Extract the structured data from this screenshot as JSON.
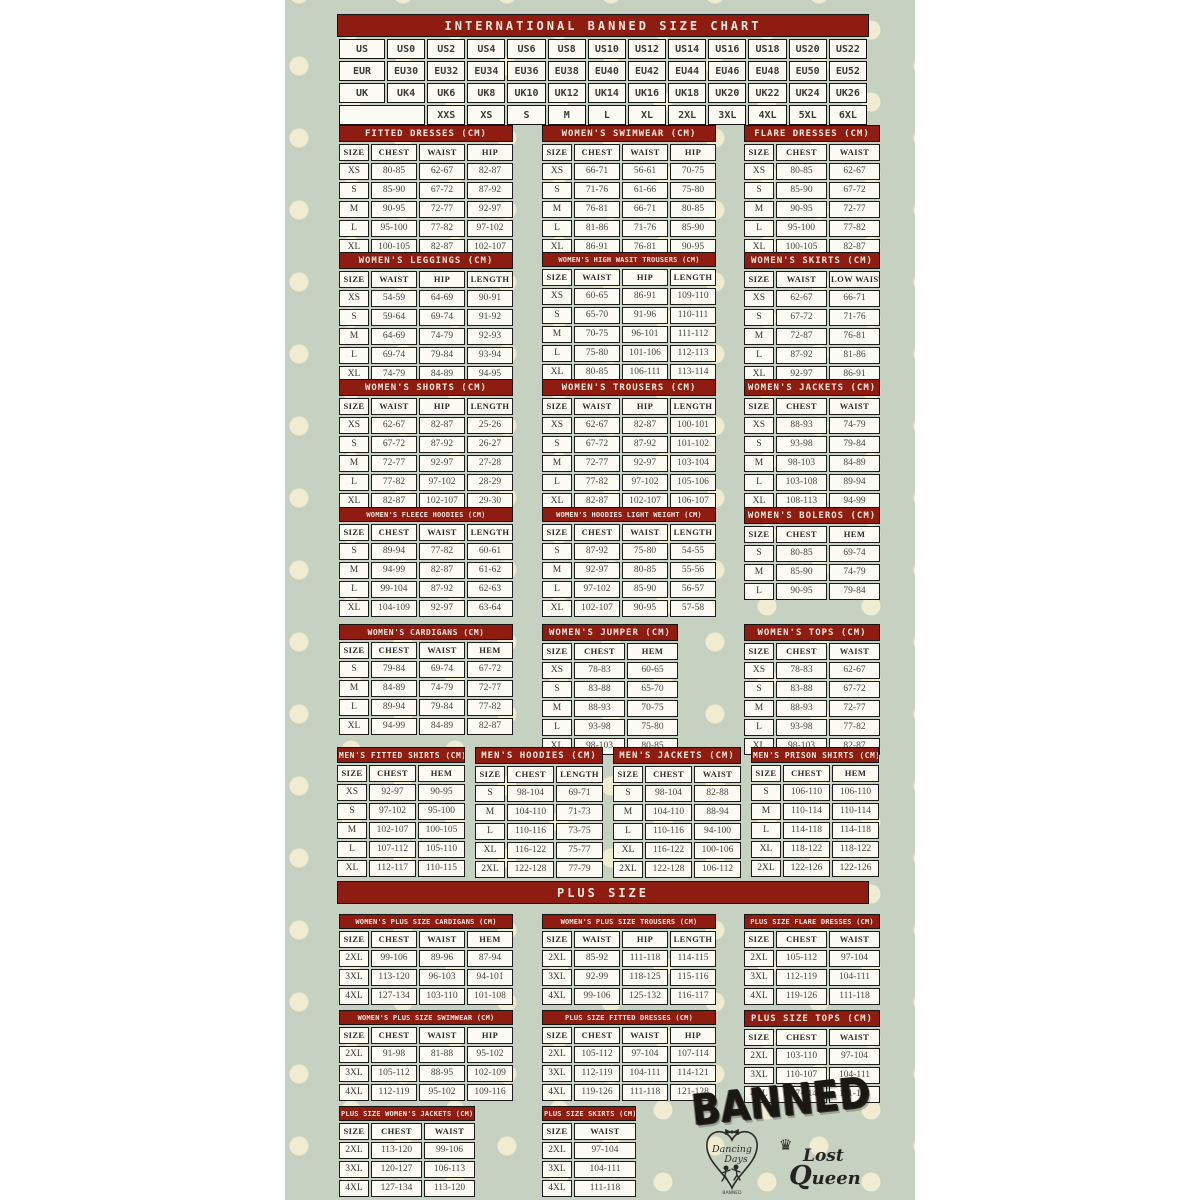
{
  "colors": {
    "header_red": "#8e1c10",
    "background_sage": "#c6d1c2",
    "dot_cream": "#efecd2",
    "cell_bg": "#fbfaf3",
    "border_black": "#1c1c1c"
  },
  "banner": {
    "title": "INTERNATIONAL BANNED SIZE CHART",
    "plus_size": "PLUS SIZE"
  },
  "international": {
    "rows": [
      [
        "US",
        "US0",
        "US2",
        "US4",
        "US6",
        "US8",
        "US10",
        "US12",
        "US14",
        "US16",
        "US18",
        "US20",
        "US22"
      ],
      [
        "EUR",
        "EU30",
        "EU32",
        "EU34",
        "EU36",
        "EU38",
        "EU40",
        "EU42",
        "EU44",
        "EU46",
        "EU48",
        "EU50",
        "EU52"
      ],
      [
        "UK",
        "UK4",
        "UK6",
        "UK8",
        "UK10",
        "UK12",
        "UK14",
        "UK16",
        "UK18",
        "UK20",
        "UK22",
        "UK24",
        "UK26"
      ],
      [
        "",
        "XXS",
        "XS",
        "S",
        "M",
        "L",
        "XL",
        "2XL",
        "3XL",
        "4XL",
        "5XL",
        "6XL"
      ]
    ]
  },
  "tables": {
    "fitted_dresses": {
      "title": "FITTED DRESSES (CM)",
      "headers": [
        "SIZE",
        "CHEST",
        "WAIST",
        "HIP"
      ],
      "rows": [
        [
          "XS",
          "80-85",
          "62-67",
          "82-87"
        ],
        [
          "S",
          "85-90",
          "67-72",
          "87-92"
        ],
        [
          "M",
          "90-95",
          "72-77",
          "92-97"
        ],
        [
          "L",
          "95-100",
          "77-82",
          "97-102"
        ],
        [
          "XL",
          "100-105",
          "82-87",
          "102-107"
        ]
      ]
    },
    "womens_swimwear": {
      "title": "WOMEN'S SWIMWEAR (CM)",
      "headers": [
        "SIZE",
        "CHEST",
        "WAIST",
        "HIP"
      ],
      "rows": [
        [
          "XS",
          "66-71",
          "56-61",
          "70-75"
        ],
        [
          "S",
          "71-76",
          "61-66",
          "75-80"
        ],
        [
          "M",
          "76-81",
          "66-71",
          "80-85"
        ],
        [
          "L",
          "81-86",
          "71-76",
          "85-90"
        ],
        [
          "XL",
          "86-91",
          "76-81",
          "90-95"
        ]
      ]
    },
    "flare_dresses": {
      "title": "FLARE DRESSES (CM)",
      "headers": [
        "SIZE",
        "CHEST",
        "WAIST"
      ],
      "rows": [
        [
          "XS",
          "80-85",
          "62-67"
        ],
        [
          "S",
          "85-90",
          "67-72"
        ],
        [
          "M",
          "90-95",
          "72-77"
        ],
        [
          "L",
          "95-100",
          "77-82"
        ],
        [
          "XL",
          "100-105",
          "82-87"
        ]
      ]
    },
    "womens_leggings": {
      "title": "WOMEN'S LEGGINGS (CM)",
      "headers": [
        "SIZE",
        "WAIST",
        "HIP",
        "LENGTH"
      ],
      "rows": [
        [
          "XS",
          "54-59",
          "64-69",
          "90-91"
        ],
        [
          "S",
          "59-64",
          "69-74",
          "91-92"
        ],
        [
          "M",
          "64-69",
          "74-79",
          "92-93"
        ],
        [
          "L",
          "69-74",
          "79-84",
          "93-94"
        ],
        [
          "XL",
          "74-79",
          "84-89",
          "94-95"
        ]
      ]
    },
    "high_waist_trousers": {
      "title": "WOMEN'S HIGH WASIT TROUSERS (CM)",
      "headers": [
        "SIZE",
        "WAIST",
        "HIP",
        "LENGTH"
      ],
      "rows": [
        [
          "XS",
          "60-65",
          "86-91",
          "109-110"
        ],
        [
          "S",
          "65-70",
          "91-96",
          "110-111"
        ],
        [
          "M",
          "70-75",
          "96-101",
          "111-112"
        ],
        [
          "L",
          "75-80",
          "101-106",
          "112-113"
        ],
        [
          "XL",
          "80-85",
          "106-111",
          "113-114"
        ]
      ]
    },
    "womens_skirts": {
      "title": "WOMEN'S SKIRTS (CM)",
      "headers": [
        "SIZE",
        "WAIST",
        "LOW WAIST"
      ],
      "rows": [
        [
          "XS",
          "62-67",
          "66-71"
        ],
        [
          "S",
          "67-72",
          "71-76"
        ],
        [
          "M",
          "72-87",
          "76-81"
        ],
        [
          "L",
          "87-92",
          "81-86"
        ],
        [
          "XL",
          "92-97",
          "86-91"
        ]
      ]
    },
    "womens_shorts": {
      "title": "WOMEN'S SHORTS (CM)",
      "headers": [
        "SIZE",
        "WAIST",
        "HIP",
        "LENGTH"
      ],
      "rows": [
        [
          "XS",
          "62-67",
          "82-87",
          "25-26"
        ],
        [
          "S",
          "67-72",
          "87-92",
          "26-27"
        ],
        [
          "M",
          "72-77",
          "92-97",
          "27-28"
        ],
        [
          "L",
          "77-82",
          "97-102",
          "28-29"
        ],
        [
          "XL",
          "82-87",
          "102-107",
          "29-30"
        ]
      ]
    },
    "womens_trousers": {
      "title": "WOMEN'S TROUSERS (CM)",
      "headers": [
        "SIZE",
        "WAIST",
        "HIP",
        "LENGTH"
      ],
      "rows": [
        [
          "XS",
          "62-67",
          "82-87",
          "100-101"
        ],
        [
          "S",
          "67-72",
          "87-92",
          "101-102"
        ],
        [
          "M",
          "72-77",
          "92-97",
          "103-104"
        ],
        [
          "L",
          "77-82",
          "97-102",
          "105-106"
        ],
        [
          "XL",
          "82-87",
          "102-107",
          "106-107"
        ]
      ]
    },
    "womens_jackets": {
      "title": "WOMEN'S JACKETS (CM)",
      "headers": [
        "SIZE",
        "CHEST",
        "WAIST"
      ],
      "rows": [
        [
          "XS",
          "88-93",
          "74-79"
        ],
        [
          "S",
          "93-98",
          "79-84"
        ],
        [
          "M",
          "98-103",
          "84-89"
        ],
        [
          "L",
          "103-108",
          "89-94"
        ],
        [
          "XL",
          "108-113",
          "94-99"
        ]
      ]
    },
    "fleece_hoodies": {
      "title": "WOMEN'S FLEECE HOODIES (CM)",
      "headers": [
        "SIZE",
        "CHEST",
        "WAIST",
        "LENGTH"
      ],
      "rows": [
        [
          "S",
          "89-94",
          "77-82",
          "60-61"
        ],
        [
          "M",
          "94-99",
          "82-87",
          "61-62"
        ],
        [
          "L",
          "99-104",
          "87-92",
          "62-63"
        ],
        [
          "XL",
          "104-109",
          "92-97",
          "63-64"
        ]
      ]
    },
    "hoodies_light": {
      "title": "WOMEN'S HOODIES LIGHT WEIGHT (CM)",
      "headers": [
        "SIZE",
        "CHEST",
        "WAIST",
        "LENGTH"
      ],
      "rows": [
        [
          "S",
          "87-92",
          "75-80",
          "54-55"
        ],
        [
          "M",
          "92-97",
          "80-85",
          "55-56"
        ],
        [
          "L",
          "97-102",
          "85-90",
          "56-57"
        ],
        [
          "XL",
          "102-107",
          "90-95",
          "57-58"
        ]
      ]
    },
    "womens_boleros": {
      "title": "WOMEN'S BOLEROS (CM)",
      "headers": [
        "SIZE",
        "CHEST",
        "HEM"
      ],
      "rows": [
        [
          "S",
          "80-85",
          "69-74"
        ],
        [
          "M",
          "85-90",
          "74-79"
        ],
        [
          "L",
          "90-95",
          "79-84"
        ]
      ]
    },
    "womens_cardigans": {
      "title": "WOMEN'S CARDIGANS (CM)",
      "headers": [
        "SIZE",
        "CHEST",
        "WAIST",
        "HEM"
      ],
      "rows": [
        [
          "S",
          "79-84",
          "69-74",
          "67-72"
        ],
        [
          "M",
          "84-89",
          "74-79",
          "72-77"
        ],
        [
          "L",
          "89-94",
          "79-84",
          "77-82"
        ],
        [
          "XL",
          "94-99",
          "84-89",
          "82-87"
        ]
      ]
    },
    "womens_jumper": {
      "title": "WOMEN'S JUMPER (CM)",
      "headers": [
        "SIZE",
        "CHEST",
        "HEM"
      ],
      "rows": [
        [
          "XS",
          "78-83",
          "60-65"
        ],
        [
          "S",
          "83-88",
          "65-70"
        ],
        [
          "M",
          "88-93",
          "70-75"
        ],
        [
          "L",
          "93-98",
          "75-80"
        ],
        [
          "XL",
          "98-103",
          "80-85"
        ]
      ]
    },
    "womens_tops": {
      "title": "WOMEN'S TOPS (CM)",
      "headers": [
        "SIZE",
        "CHEST",
        "WAIST"
      ],
      "rows": [
        [
          "XS",
          "78-83",
          "62-67"
        ],
        [
          "S",
          "83-88",
          "67-72"
        ],
        [
          "M",
          "88-93",
          "72-77"
        ],
        [
          "L",
          "93-98",
          "77-82"
        ],
        [
          "XL",
          "98-103",
          "82-87"
        ]
      ]
    },
    "mens_fitted_shirts": {
      "title": "MEN'S FITTED SHIRTS (CM)",
      "headers": [
        "SIZE",
        "CHEST",
        "HEM"
      ],
      "rows": [
        [
          "XS",
          "92-97",
          "90-95"
        ],
        [
          "S",
          "97-102",
          "95-100"
        ],
        [
          "M",
          "102-107",
          "100-105"
        ],
        [
          "L",
          "107-112",
          "105-110"
        ],
        [
          "XL",
          "112-117",
          "110-115"
        ]
      ]
    },
    "mens_hoodies": {
      "title": "MEN'S HOODIES (CM)",
      "headers": [
        "SIZE",
        "CHEST",
        "LENGTH"
      ],
      "rows": [
        [
          "S",
          "98-104",
          "69-71"
        ],
        [
          "M",
          "104-110",
          "71-73"
        ],
        [
          "L",
          "110-116",
          "73-75"
        ],
        [
          "XL",
          "116-122",
          "75-77"
        ],
        [
          "2XL",
          "122-128",
          "77-79"
        ]
      ]
    },
    "mens_jackets": {
      "title": "MEN'S JACKETS (CM)",
      "headers": [
        "SIZE",
        "CHEST",
        "WAIST"
      ],
      "rows": [
        [
          "S",
          "98-104",
          "82-88"
        ],
        [
          "M",
          "104-110",
          "88-94"
        ],
        [
          "L",
          "110-116",
          "94-100"
        ],
        [
          "XL",
          "116-122",
          "100-106"
        ],
        [
          "2XL",
          "122-128",
          "106-112"
        ]
      ]
    },
    "mens_prison_shirts": {
      "title": "MEN'S PRISON SHIRTS (CM)",
      "headers": [
        "SIZE",
        "CHEST",
        "HEM"
      ],
      "rows": [
        [
          "S",
          "106-110",
          "106-110"
        ],
        [
          "M",
          "110-114",
          "110-114"
        ],
        [
          "L",
          "114-118",
          "114-118"
        ],
        [
          "XL",
          "118-122",
          "118-122"
        ],
        [
          "2XL",
          "122-126",
          "122-126"
        ]
      ]
    },
    "plus_cardigans": {
      "title": "WOMEN'S PLUS SIZE CARDIGANS (CM)",
      "headers": [
        "SIZE",
        "CHEST",
        "WAIST",
        "HEM"
      ],
      "rows": [
        [
          "2XL",
          "99-106",
          "89-96",
          "87-94"
        ],
        [
          "3XL",
          "113-120",
          "96-103",
          "94-101"
        ],
        [
          "4XL",
          "127-134",
          "103-110",
          "101-108"
        ]
      ]
    },
    "plus_trousers": {
      "title": "WOMEN'S PLUS SIZE TROUSERS (CM)",
      "headers": [
        "SIZE",
        "WAIST",
        "HIP",
        "LENGTH"
      ],
      "rows": [
        [
          "2XL",
          "85-92",
          "111-118",
          "114-115"
        ],
        [
          "3XL",
          "92-99",
          "118-125",
          "115-116"
        ],
        [
          "4XL",
          "99-106",
          "125-132",
          "116-117"
        ]
      ]
    },
    "plus_flare_dresses": {
      "title": "PLUS SIZE FLARE DRESSES (CM)",
      "headers": [
        "SIZE",
        "CHEST",
        "WAIST"
      ],
      "rows": [
        [
          "2XL",
          "105-112",
          "97-104"
        ],
        [
          "3XL",
          "112-119",
          "104-111"
        ],
        [
          "4XL",
          "119-126",
          "111-118"
        ]
      ]
    },
    "plus_swimwear": {
      "title": "WOMEN'S PLUS SIZE SWIMWEAR (CM)",
      "headers": [
        "SIZE",
        "CHEST",
        "WAIST",
        "HIP"
      ],
      "rows": [
        [
          "2XL",
          "91-98",
          "81-88",
          "95-102"
        ],
        [
          "3XL",
          "105-112",
          "88-95",
          "102-109"
        ],
        [
          "4XL",
          "112-119",
          "95-102",
          "109-116"
        ]
      ]
    },
    "plus_fitted_dresses": {
      "title": "PLUS SIZE FITTED DRESSES (CM)",
      "headers": [
        "SIZE",
        "CHEST",
        "WAIST",
        "HIP"
      ],
      "rows": [
        [
          "2XL",
          "105-112",
          "97-104",
          "107-114"
        ],
        [
          "3XL",
          "112-119",
          "104-111",
          "114-121"
        ],
        [
          "4XL",
          "119-126",
          "111-118",
          "121-128"
        ]
      ]
    },
    "plus_tops": {
      "title": "PLUS SIZE TOPS (CM)",
      "headers": [
        "SIZE",
        "CHEST",
        "WAIST"
      ],
      "rows": [
        [
          "2XL",
          "103-110",
          "97-104"
        ],
        [
          "3XL",
          "110-107",
          "104-111"
        ],
        [
          "4XL",
          "107-114",
          "111-118"
        ]
      ]
    },
    "plus_jackets": {
      "title": "PLUS SIZE WOMEN'S JACKETS (CM)",
      "headers": [
        "SIZE",
        "CHEST",
        "WAIST"
      ],
      "rows": [
        [
          "2XL",
          "113-120",
          "99-106"
        ],
        [
          "3XL",
          "120-127",
          "106-113"
        ],
        [
          "4XL",
          "127-134",
          "113-120"
        ]
      ]
    },
    "plus_skirts": {
      "title": "PLUS SIZE SKIRTS (CM)",
      "headers": [
        "SIZE",
        "WAIST"
      ],
      "rows": [
        [
          "2XL",
          "97-104"
        ],
        [
          "3XL",
          "104-111"
        ],
        [
          "4XL",
          "111-118"
        ]
      ]
    }
  },
  "logos": {
    "banned": "BANNED",
    "dancing_days": {
      "line1": "Dancing",
      "line2": "Days",
      "caption": "BANNED"
    },
    "lost_queen": {
      "line1": "Lost",
      "line2": "Queen"
    }
  }
}
